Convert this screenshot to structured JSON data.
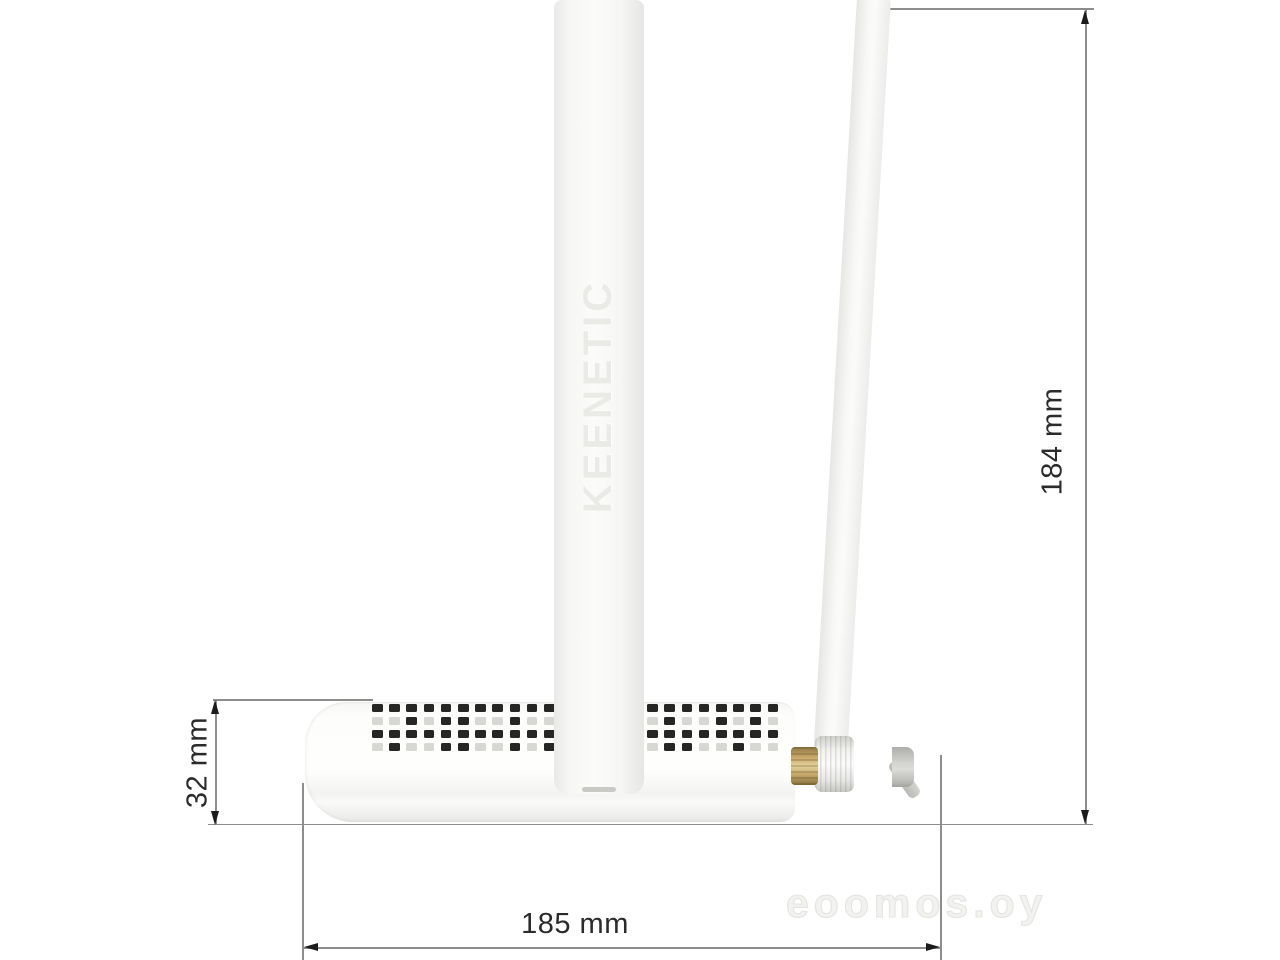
{
  "figure": {
    "title": "Keenetic router side view with dimensions",
    "brand_text": "KEENETIC",
    "watermark_text": "eoomos.oy"
  },
  "dimensions": {
    "width": "185 mm",
    "total_height": "184 mm",
    "body_height": "32 mm"
  },
  "colors": {
    "dimension_line": "#8d8d8b",
    "arrow": "#1b1b1b",
    "label_text": "#2b2b2b",
    "device_white": "#fdfdfc",
    "vent_dark": "#262624",
    "vent_light": "#d7d7d3",
    "brass_connector": "#caa96a",
    "joint_gray": "#c9c9c5",
    "watermark": "#e9e9e6"
  },
  "vents": {
    "columns": 24,
    "rows": [
      [
        1,
        1,
        1,
        1,
        1,
        1,
        1,
        1,
        1,
        1,
        1,
        1,
        1,
        1,
        1,
        1,
        1,
        1,
        1,
        1,
        1,
        1,
        1,
        1
      ],
      [
        0,
        0,
        1,
        0,
        1,
        1,
        0,
        0,
        1,
        0,
        0,
        1,
        0,
        0,
        1,
        1,
        0,
        1,
        0,
        0,
        1,
        0,
        1,
        0
      ],
      [
        1,
        1,
        1,
        1,
        1,
        1,
        1,
        1,
        1,
        1,
        1,
        1,
        1,
        1,
        1,
        1,
        1,
        1,
        1,
        1,
        1,
        1,
        1,
        1
      ],
      [
        0,
        1,
        0,
        0,
        1,
        1,
        0,
        0,
        1,
        0,
        1,
        0,
        0,
        0,
        1,
        0,
        0,
        1,
        1,
        0,
        0,
        1,
        0,
        0
      ]
    ]
  }
}
